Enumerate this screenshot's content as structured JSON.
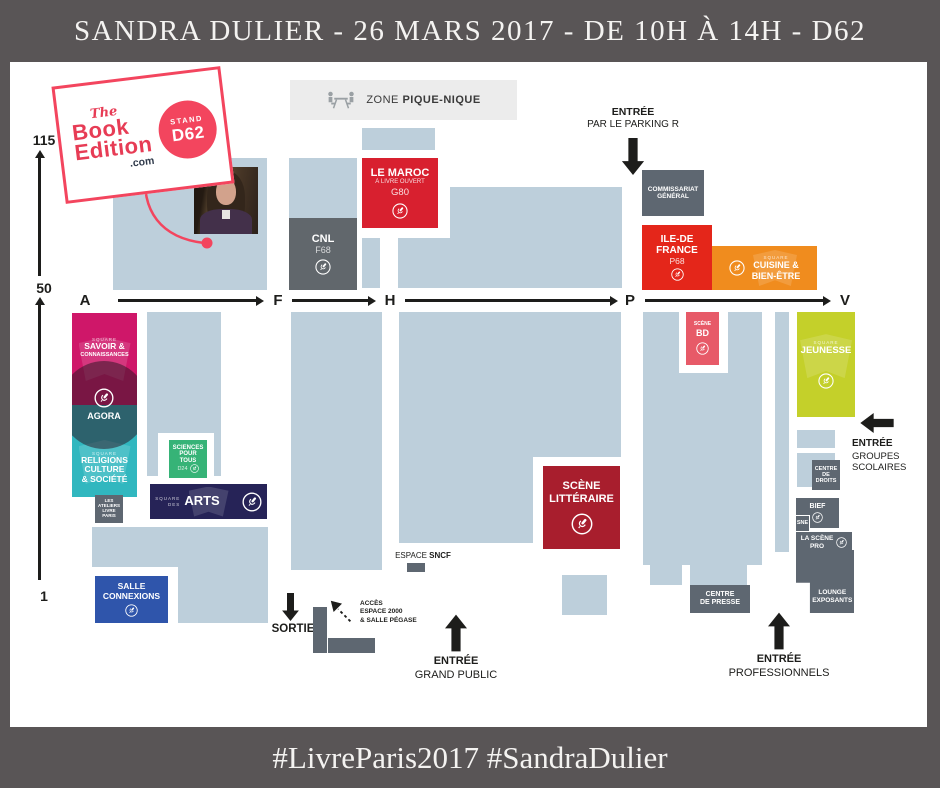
{
  "header": {
    "title": "SANDRA DULIER - 26 MARS 2017 - DE 10H À 14H - D62"
  },
  "footer": {
    "hashtags": "#LivreParis2017 #SandraDulier"
  },
  "logo": {
    "the": "The",
    "book": "Book",
    "edition": "Edition",
    "com": ".com",
    "stand_label": "STAND",
    "stand_code": "D62"
  },
  "axes": {
    "v115": "115",
    "v50": "50",
    "v1": "1",
    "a": "A",
    "f": "F",
    "h": "H",
    "p": "P",
    "v": "V"
  },
  "picnic": {
    "prefix": "ZONE ",
    "name": "PIQUE-NIQUE"
  },
  "entrances": {
    "parking": {
      "l1": "ENTRÉE",
      "l2": "PAR LE PARKING R"
    },
    "scolaires": {
      "l1": "ENTRÉE",
      "l2": "GROUPES",
      "l3": "SCOLAIRES"
    },
    "grand_public": {
      "l1": "ENTRÉE",
      "l2": "GRAND PUBLIC"
    },
    "professionnels": {
      "l1": "ENTRÉE",
      "l2": "PROFESSIONNELS"
    },
    "sortie": "SORTIE",
    "acces": {
      "l1": "ACCÈS",
      "l2": "ESPACE 2000",
      "l3": "& SALLE PÉGASE"
    }
  },
  "stands": {
    "maroc": {
      "l1": "LE MAROC",
      "l2": "À LIVRE OUVERT",
      "code": "G80"
    },
    "cnl": {
      "name": "CNL",
      "code": "F68"
    },
    "commissariat": {
      "l1": "COMMISSARIAT",
      "l2": "GÉNÉRAL"
    },
    "idf": {
      "l1": "ILE-DE",
      "l2": "FRANCE",
      "code": "P68"
    },
    "cuisine": {
      "sq": "SQUARE",
      "l1": "CUISINE &",
      "l2": "BIEN-ÊTRE"
    },
    "savoir": {
      "sq": "SQUARE",
      "l1": "SAVOIR &",
      "l2": "CONNAISSANCES"
    },
    "agora": {
      "name": "AGORA"
    },
    "religions": {
      "sq": "SQUARE",
      "l1": "RELIGIONS",
      "l2": "CULTURE",
      "l3": "& SOCIÉTÉ"
    },
    "ateliers": {
      "l1": "LES",
      "l2": "ATELIERS",
      "l3": "LIVRE",
      "l4": "PARIS"
    },
    "sciences": {
      "l1": "SCIENCES",
      "l2": "POUR",
      "l3": "TOUS",
      "code": "D24"
    },
    "arts": {
      "sq": "SQUARE",
      "sq2": "DES",
      "name": "ARTS"
    },
    "connexions": {
      "l1": "SALLE",
      "l2": "CONNEXIONS"
    },
    "bd": {
      "l1": "SCÈNE",
      "l2": "BD"
    },
    "jeunesse": {
      "sq": "SQUARE",
      "name": "JEUNESSE"
    },
    "litteraire": {
      "l1": "SCÈNE",
      "l2": "LITTÉRAIRE"
    },
    "sncf": {
      "prefix": "ESPACE ",
      "name": "SNCF"
    },
    "droits": {
      "l1": "CENTRE",
      "l2": "DE",
      "l3": "DROITS"
    },
    "bief": {
      "name": "BIEF"
    },
    "sne": {
      "name": "SNE"
    },
    "pro": {
      "l1": "LA SCÈNE",
      "l2": "PRO"
    },
    "lounge": {
      "l1": "LOUNGE",
      "l2": "EXPOSANTS"
    },
    "presse": {
      "l1": "CENTRE",
      "l2": "DE PRESSE"
    }
  },
  "colors": {
    "frame": "#595556",
    "block": "#bdcfdb",
    "slate": "#5e6771",
    "gray_dark": "#61676c",
    "red_maroc": "#d8202f",
    "red_idf": "#e4261a",
    "orange": "#f08c1e",
    "magenta": "#cf1769",
    "teal": "#31b7bf",
    "green": "#36b377",
    "navy": "#262357",
    "blue": "#2f55ab",
    "dark_red": "#a81e2d",
    "pink_bd": "#e75a68",
    "lime": "#c4d02a",
    "picnic_bg": "#ececec",
    "logo_pink": "#f3455e",
    "logo_red": "#e73c55",
    "logo_navy": "#303a4b",
    "ink": "#1d1d1b"
  }
}
